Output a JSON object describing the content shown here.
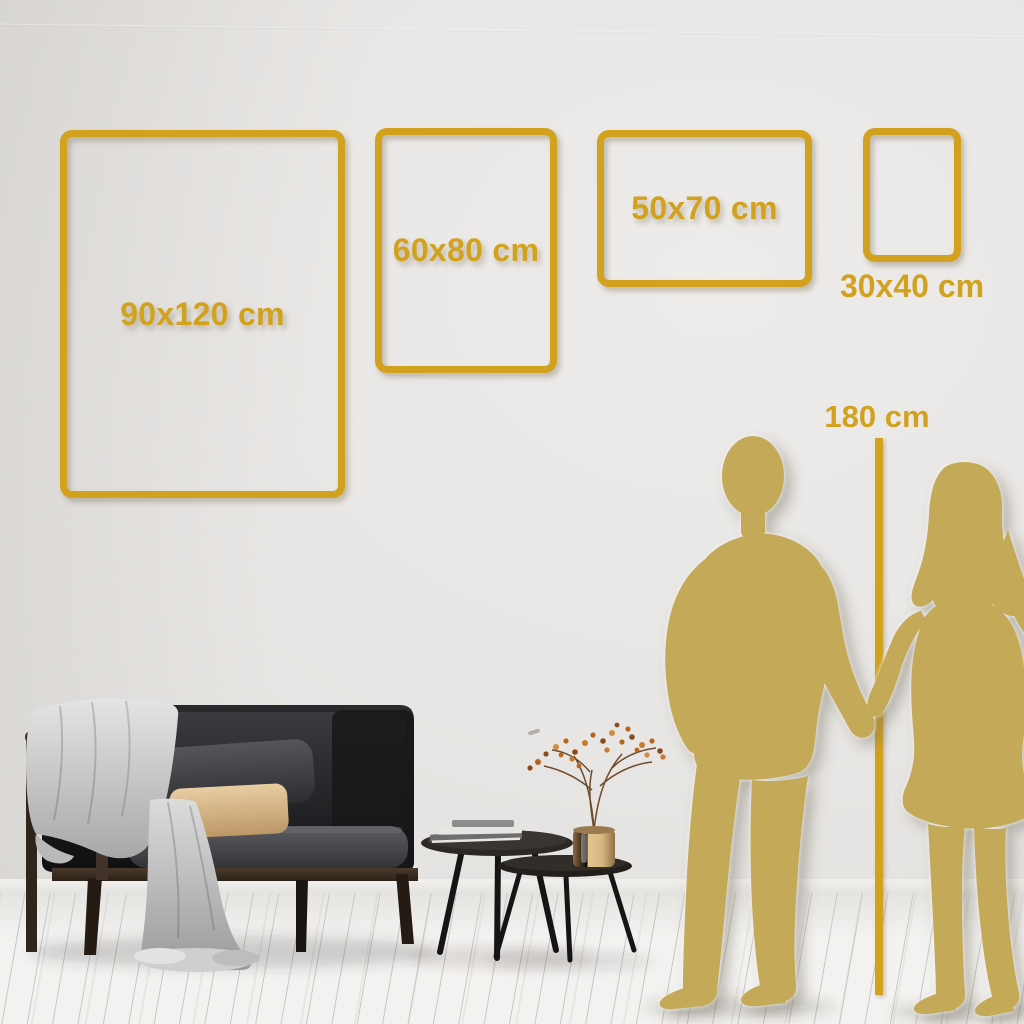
{
  "scene_title": "Poster frame size comparison wall scene",
  "sizes": [
    {
      "id": "90x120",
      "label": "90x120 cm",
      "label_position": "inside"
    },
    {
      "id": "60x80",
      "label": "60x80 cm",
      "label_position": "inside"
    },
    {
      "id": "50x70",
      "label": "50x70 cm",
      "label_position": "inside"
    },
    {
      "id": "30x40",
      "label": "30x40 cm",
      "label_position": "below"
    }
  ],
  "height_reference": {
    "label": "180 cm"
  },
  "colors": {
    "accent": "#D2A21E",
    "silhouette": "#C4AA58",
    "wall": "#E7E4E1",
    "floor": "#F3F2F0",
    "pillow_beige": "#D9B888",
    "sofa": "#1B1B1D"
  },
  "icons": {
    "man": "man-silhouette",
    "woman": "woman-silhouette",
    "marker": "height-marker-line"
  }
}
